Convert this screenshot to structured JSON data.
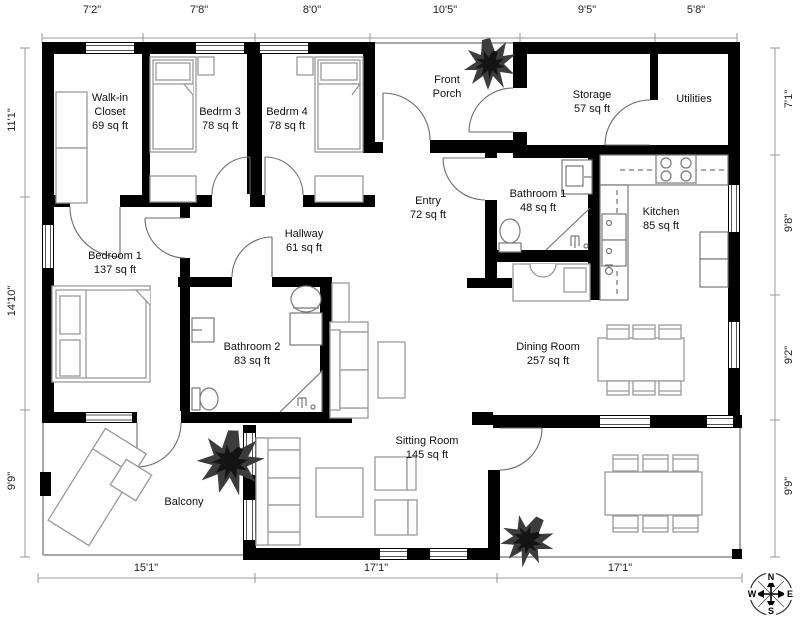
{
  "dimensions": {
    "top": [
      "7'2\"",
      "7'8\"",
      "8'0\"",
      "10'5\"",
      "9'5\"",
      "5'8\""
    ],
    "left": [
      "11'1\"",
      "14'10\"",
      "9'9\""
    ],
    "right": [
      "7'1\"",
      "9'8\"",
      "9'2\"",
      "9'9\""
    ],
    "bottom": [
      "15'1\"",
      "17'1\"",
      "17'1\""
    ]
  },
  "rooms": {
    "walk_in_closet": {
      "name": "Walk-in Closet",
      "area": "69 sq ft"
    },
    "bedrm3": {
      "name": "Bedrm 3",
      "area": "78 sq ft"
    },
    "bedrm4": {
      "name": "Bedrm 4",
      "area": "78 sq ft"
    },
    "front_porch": {
      "name": "Front Porch",
      "area": ""
    },
    "storage": {
      "name": "Storage",
      "area": "57 sq ft"
    },
    "utilities": {
      "name": "Utilities",
      "area": ""
    },
    "entry": {
      "name": "Entry",
      "area": "72 sq ft"
    },
    "bathroom1": {
      "name": "Bathroom 1",
      "area": "48 sq ft"
    },
    "kitchen": {
      "name": "Kitchen",
      "area": "85 sq ft"
    },
    "bedroom1": {
      "name": "Bedroom 1",
      "area": "137 sq ft"
    },
    "hallway": {
      "name": "Hallway",
      "area": "61 sq ft"
    },
    "bathroom2": {
      "name": "Bathroom 2",
      "area": "83 sq ft"
    },
    "dining_room": {
      "name": "Dining Room",
      "area": "257 sq ft"
    },
    "sitting_room": {
      "name": "Sitting Room",
      "area": "145 sq ft"
    },
    "balcony": {
      "name": "Balcony",
      "area": ""
    }
  },
  "compass": {
    "n": "N",
    "e": "E",
    "s": "S",
    "w": "W"
  },
  "colors": {
    "wall": "#000000",
    "ruler": "#9a9a9a",
    "furniture": "#9a9a9a",
    "text": "#111111",
    "background": "#ffffff"
  }
}
